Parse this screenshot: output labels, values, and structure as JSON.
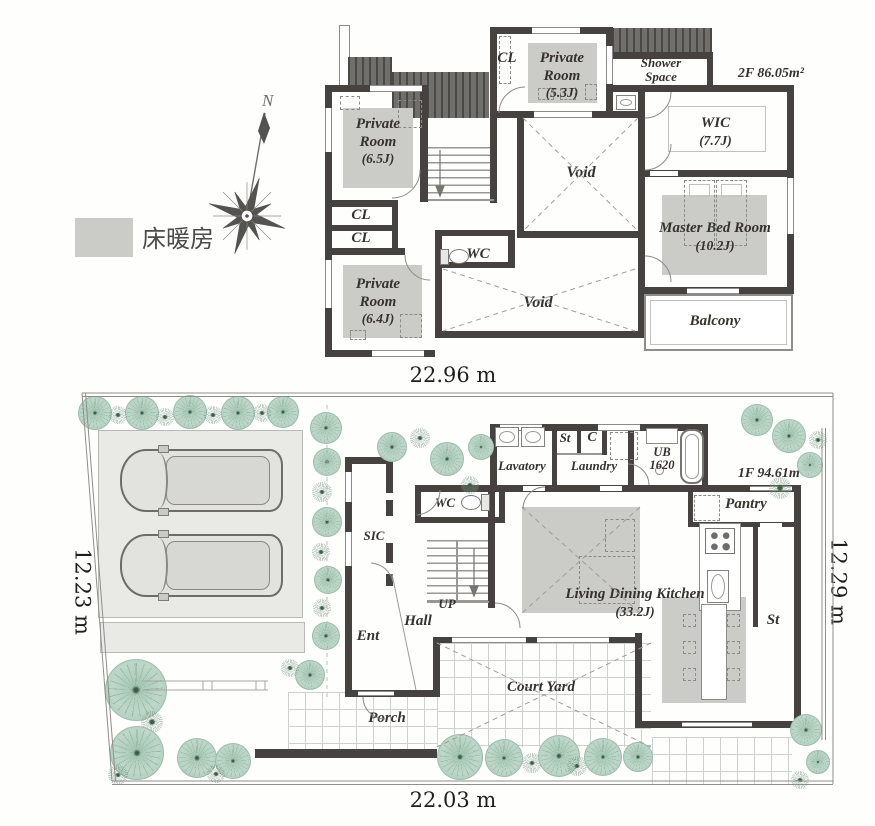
{
  "legend": {
    "floor_heating": "床暖房"
  },
  "compass": {
    "north": "N"
  },
  "floor2": {
    "area": "2F 86.05m²",
    "rooms": {
      "private_a": {
        "name": "Private Room",
        "size": "(6.5J)"
      },
      "closet_top": "CL",
      "private_b": {
        "name": "Private Room",
        "size": "(5.3J)"
      },
      "shower": "Shower Space",
      "wic": {
        "name": "WIC",
        "size": "(7.7J)"
      },
      "void_center": "Void",
      "down": "DN",
      "closet_1": "CL",
      "closet_2": "CL",
      "wc": "WC",
      "private_c": {
        "name": "Private Room",
        "size": "(6.4J)"
      },
      "void_lower": "Void",
      "master": {
        "name": "Master Bed Room",
        "size": "(10.2J)"
      },
      "balcony": "Balcony"
    }
  },
  "floor1": {
    "area": "1F 94.61m²",
    "rooms": {
      "lavatory": "Lavatory",
      "storage_top": "St",
      "closet": "C",
      "laundry": "Laundry",
      "bath": "UB 1620",
      "pantry": "Pantry",
      "wc": "WC",
      "sic": "SIC",
      "up": "UP",
      "ldk": {
        "name": "Living Dining Kitchen",
        "size": "(33.2J)"
      },
      "storage_right": "St",
      "hall": "Hall",
      "entrance": "Ent",
      "courtyard": "Court Yard",
      "porch": "Porch"
    }
  },
  "dimensions": {
    "top": "22.96 m",
    "left": "12.23 m",
    "right": "12.29 m",
    "bottom": "22.03 m"
  }
}
